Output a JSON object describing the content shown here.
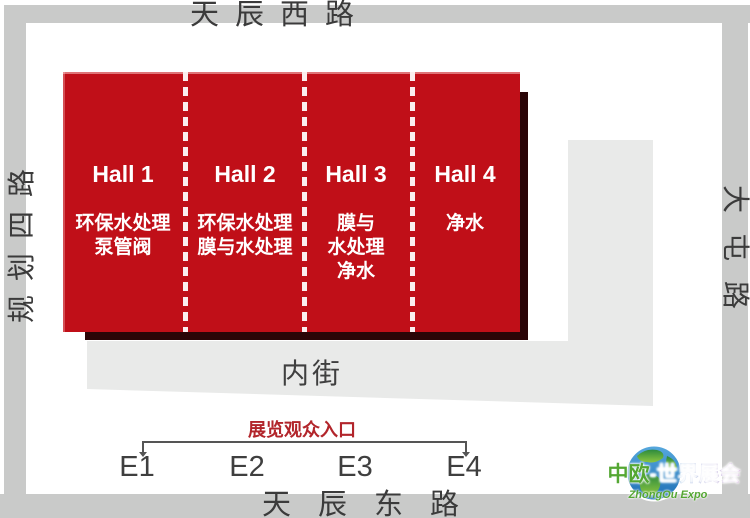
{
  "roads": {
    "top": "天辰西路",
    "bottom": "天辰东路",
    "left": "规划四路",
    "right": "大屯路"
  },
  "halls": [
    {
      "name": "Hall 1",
      "line1": "环保水处理",
      "line2": "泵管阀"
    },
    {
      "name": "Hall 2",
      "line1": "环保水处理",
      "line2": "膜与水处理"
    },
    {
      "name": "Hall 3",
      "line1": "膜与",
      "line2": "水处理",
      "line3": "净水"
    },
    {
      "name": "Hall 4",
      "line1": "净水"
    }
  ],
  "inner_street": {
    "label": "内街"
  },
  "entrance": {
    "label": "展览观众入口",
    "gates": [
      "E1",
      "E2",
      "E3",
      "E4"
    ]
  },
  "logo": {
    "title_primary": "中欧",
    "title_secondary": "-世界展会",
    "subtitle": "ZhongOu Expo"
  },
  "colors": {
    "hall_red": "#c00f18",
    "hall_shadow": "#2a0507",
    "divider_dash": "#fbeeee",
    "frame_gray": "#c9cac9",
    "street_gray": "#e9eae9",
    "road_text": "#3b3b3b",
    "entrance_red": "#b2252b",
    "bracket_gray": "#555555",
    "logo_green": "#55a733",
    "logo_blue": "#1f6fc0"
  }
}
